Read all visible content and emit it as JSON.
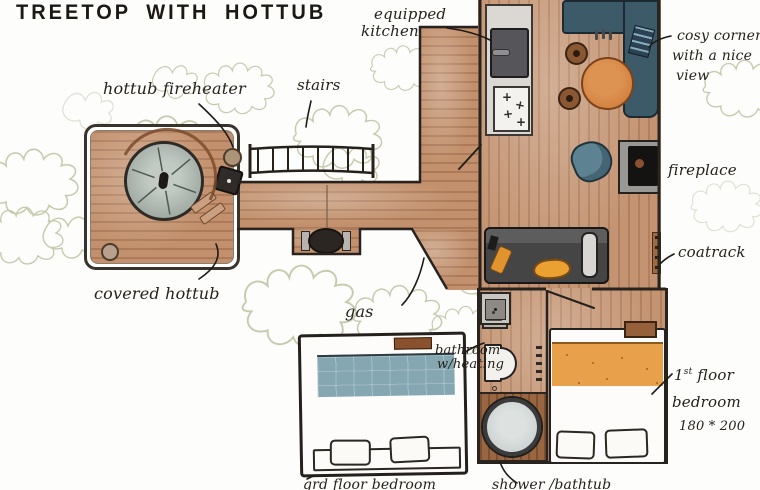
{
  "title": "TREETOP WITH HOTTUB",
  "annotations": {
    "hottub_fireheater": "hottub fireheater",
    "stairs": "stairs",
    "equipped_kitchen": [
      "equipped",
      "kitchen"
    ],
    "cosy_corner": [
      "cosy corner",
      "with a nice",
      "view"
    ],
    "fireplace": "fireplace",
    "coatrack": "coatrack",
    "covered_hottub": "covered hottub",
    "gas": "gas",
    "bathroom": [
      "bathroom",
      "w/heating"
    ],
    "first_floor_bedroom": {
      "line1_num": "1",
      "line1_sup": "st",
      "line1_rest": " floor",
      "line2": "bedroom",
      "line3": "180 * 200"
    },
    "ground_floor_bedroom": "grd floor bedroom",
    "shower_bathtub": "shower /bathtub"
  },
  "icons": {
    "burner": "+"
  },
  "colors": {
    "ink": "#26211b",
    "wood": "#c2906c",
    "wood_dark": "#9a6642",
    "counter_grey": "#dbd7d2",
    "bench_teal": "#3d5a69",
    "table_orange": "#d3803f",
    "sofa_grey": "#4b4b4b",
    "pillow_orange": "#e0932f",
    "bed_blanket_orange": "#e8a04b",
    "bed_blanket_blue": "#84a7b1",
    "hottub_grey": "#aab4ad",
    "armchair_teal": "#5d8292",
    "foliage_olive": "#9aa06b"
  }
}
